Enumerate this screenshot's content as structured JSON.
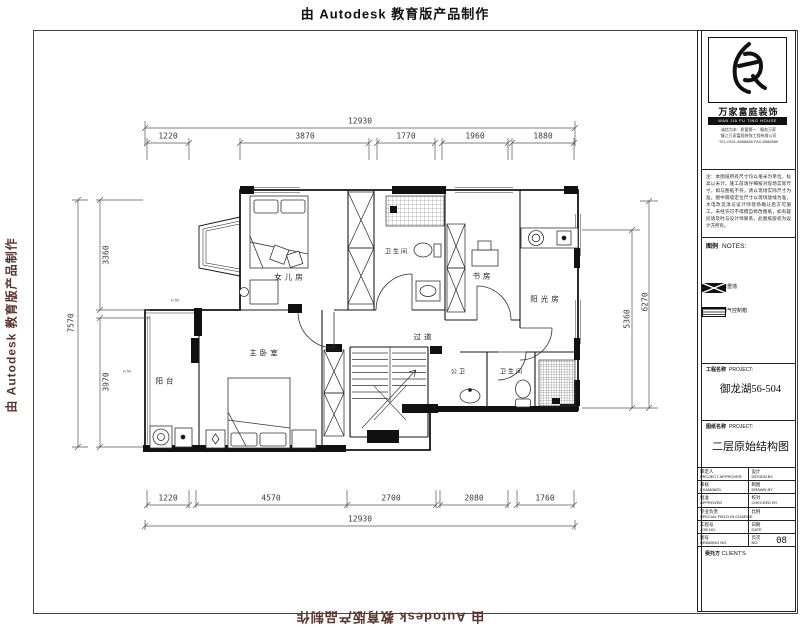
{
  "watermark": {
    "text": "由 Autodesk 教育版产品制作"
  },
  "plan": {
    "rooms": {
      "daughter": "女儿房",
      "bath_top": "卫生间",
      "study": "书房",
      "sunroom": "阳光房",
      "hallway": "过道",
      "master": "主卧室",
      "balcony": "阳台",
      "guest_wc": "公卫",
      "bath_bottom": "卫生间"
    },
    "annotations": {
      "a1": "H.50",
      "a2": "H.50"
    }
  },
  "dimensions": {
    "top": {
      "overall": "12930",
      "s1": "1220",
      "s2": "3870",
      "s3": "1770",
      "s4": "1960",
      "s5": "1880"
    },
    "bottom": {
      "overall": "12930",
      "s1": "1220",
      "s2": "4570",
      "s3": "2700",
      "s4": "2080",
      "s5": "1760"
    },
    "left": {
      "overall": "7570",
      "s1": "3360",
      "s2": "3970"
    },
    "right": {
      "outer": "6270",
      "inner": "5360"
    }
  },
  "titleblock": {
    "company": {
      "name": "万家富庭装饰",
      "name_en": "WAN JIA FU TING HOUSE",
      "contact1": "诚信为本 · 质量第一 · 服务万家",
      "contact2": "镇江万家富庭装饰工程有限公司",
      "contact3": "TEL:0511-8588888  FAX:8588889"
    },
    "notes_text": "注：本图纸所有尺寸均以毫米为单位，标高以米计。施工前请仔细核对现场实际尺寸，如与图纸不符，请以现场实际尺寸为准。图中隔墙定位尺寸以现场放线为准，水电改造须与设计师现场确认后方可施工。未经许可不得擅自修改图纸，如有疑问请及时与设计师联系。此图纸版权为设计方所有。",
    "legend": {
      "header_cn": "图例",
      "header_en": "NOTES:",
      "item1": "承重墙",
      "item2": "电气控制箱"
    },
    "project": {
      "label_cn": "工程名称",
      "label_en": "PROJECT:",
      "value": "御龙湖56-504"
    },
    "drawing": {
      "label_cn": "图纸名称",
      "label_en": "PROJECT:",
      "value": "二层原始结构图"
    },
    "table": {
      "r1l_cn": "审定人",
      "r1l_en": "PROJECT APPROVER",
      "r1r_cn": "设计",
      "r1r_en": "DESIGN BY",
      "r2l_cn": "审核",
      "r2l_en": "EXAMINED",
      "r2r_cn": "制图",
      "r2r_en": "DRAWN BY",
      "r3l_cn": "批准",
      "r3l_en": "APPROVED",
      "r3r_cn": "校对",
      "r3r_en": "CHECKED BY",
      "r4l_cn": "专业负责",
      "r4l_en": "SPECIAL FIELD IN CHARGE",
      "r4r_cn": "比例",
      "r4r_en": "",
      "r5l_cn": "工程号",
      "r5l_en": "JOB NO.",
      "r5r_cn": "日期",
      "r5r_en": "DATE",
      "r6l_cn": "图号",
      "r6l_en": "DRAWING NO.",
      "r6r_cn": "页次",
      "r6r_en": "NO.",
      "r6r_val": "08",
      "client_cn": "委托方",
      "client_en": "CLIENT'S"
    }
  }
}
